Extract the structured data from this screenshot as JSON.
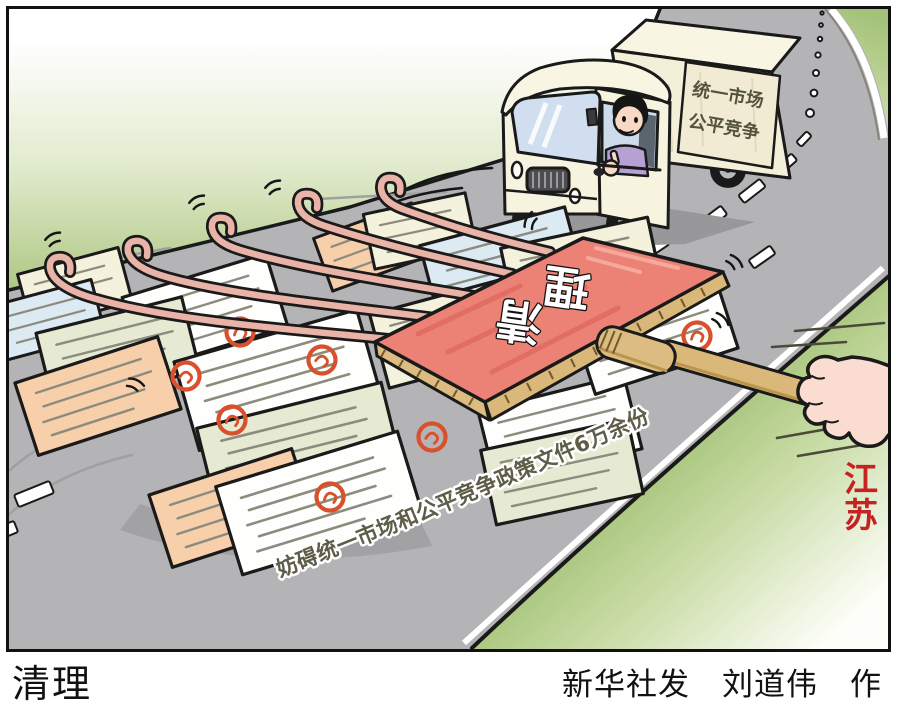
{
  "artwork": {
    "truck_sign": {
      "line1": "统一市场",
      "line2": "公平竞争"
    },
    "board_label": "清理",
    "board_chars": {
      "c1": "清",
      "c2": "理"
    },
    "pile_caption": "妨碍统一市场和公平竞争政策文件6万余份",
    "region_label": "江苏",
    "region_chars": {
      "c1": "江",
      "c2": "苏"
    }
  },
  "footer": {
    "title": "清理",
    "credit": "新华社发　刘道伟　作"
  },
  "colors": {
    "road_gray": "#b4b3b6",
    "grass_green": "#b3c98c",
    "board_red": "#ec8176",
    "wood_tan": "#d9b87a",
    "tine_pink": "#e9b3a7",
    "truck_cream": "#f6f3de",
    "seal_red": "#d8502c",
    "region_label_red": "#c52222",
    "outline_black": "#1a1a1a"
  }
}
